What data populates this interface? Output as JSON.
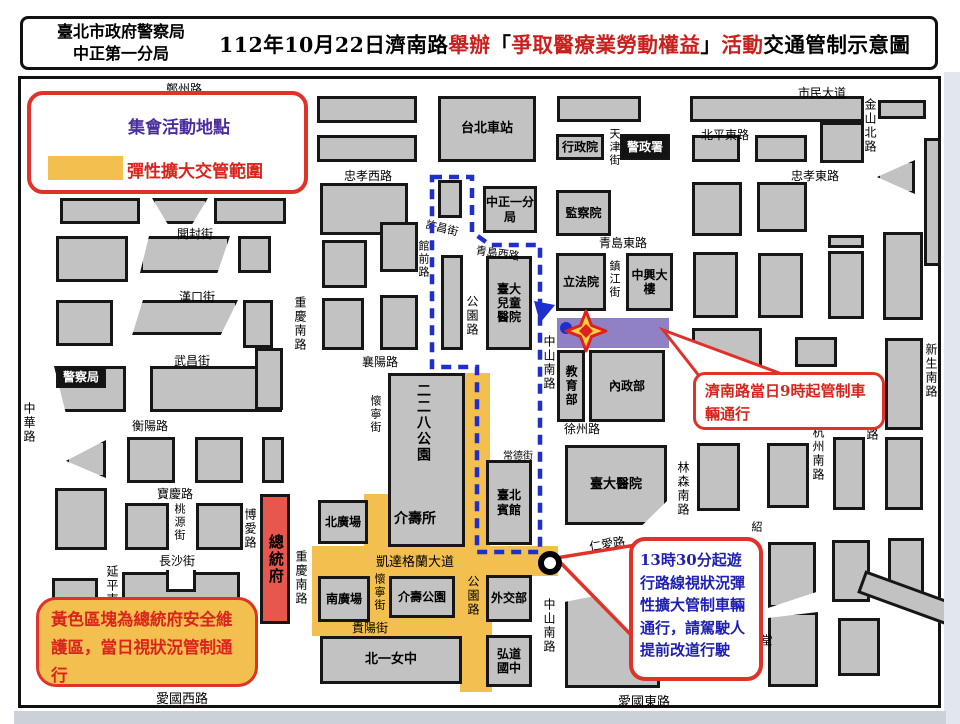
{
  "header": {
    "unit_line1": "臺北市政府警察局",
    "unit_line2": "中正第一分局",
    "title_segments": [
      {
        "text": "112年10月22日濟南路",
        "color": "black"
      },
      {
        "text": "舉辦",
        "color": "red"
      },
      {
        "text": "「",
        "color": "black"
      },
      {
        "text": "爭取醫療業勞動權益",
        "color": "red"
      },
      {
        "text": "」",
        "color": "black"
      },
      {
        "text": "活動",
        "color": "red"
      },
      {
        "text": "交通管制示意圖",
        "color": "black"
      }
    ]
  },
  "legend": {
    "star_label": "集會活動地點",
    "zone_label": "彈性擴大交管範圍"
  },
  "callouts": {
    "jinan": "濟南路當日9時起管制車輛通行",
    "flex": "13時30分起遊行路線視狀況彈性擴大管制車輛通行，請駕駛人提前改道行駛",
    "president": "黃色區塊為總統府安全維護區，當日視狀況管制通行"
  },
  "colors": {
    "accent_red": "#e03228",
    "text_red": "#d9251d",
    "text_blue": "#1f1fb4",
    "legend_purple": "#4b2e9e",
    "zone_yellow": "#f3bf4e",
    "jinan_purple": "#8f81c4",
    "president_red": "#e8574d",
    "route_blue": "#1e2ecf",
    "block_gray": "#c2c2c2"
  },
  "map": {
    "jinan_road_label": "濟南路",
    "yellow_zones": [
      [
        462,
        373,
        28,
        178
      ],
      [
        312,
        546,
        246,
        30
      ],
      [
        312,
        574,
        180,
        62
      ],
      [
        460,
        574,
        32,
        118
      ],
      [
        364,
        494,
        26,
        54
      ]
    ],
    "blocks": [
      {
        "x": 60,
        "y": 198,
        "w": 80,
        "h": 26
      },
      {
        "x": 152,
        "y": 198,
        "w": 56,
        "h": 26,
        "c": "polygon(0 0,100% 0,72% 100%,28% 100%)"
      },
      {
        "x": 214,
        "y": 198,
        "w": 72,
        "h": 26
      },
      {
        "x": 56,
        "y": 236,
        "w": 72,
        "h": 46
      },
      {
        "x": 140,
        "y": 236,
        "w": 90,
        "h": 37,
        "c": "polygon(10% 0,100% 0,86% 100%,0 100%)"
      },
      {
        "x": 238,
        "y": 236,
        "w": 33,
        "h": 37
      },
      {
        "x": 56,
        "y": 300,
        "w": 57,
        "h": 46
      },
      {
        "x": 130,
        "y": 300,
        "w": 108,
        "h": 35,
        "c": "polygon(12% 0,100% 0,84% 100%,2% 100%)"
      },
      {
        "x": 243,
        "y": 300,
        "w": 30,
        "h": 48
      },
      {
        "x": 54,
        "y": 366,
        "w": 72,
        "h": 46,
        "c": "polygon(0 0,100% 0,100% 100%,16% 100%)"
      },
      {
        "x": 150,
        "y": 366,
        "w": 132,
        "h": 46
      },
      {
        "x": 255,
        "y": 348,
        "w": 28,
        "h": 62
      },
      {
        "x": 66,
        "y": 440,
        "w": 40,
        "h": 38,
        "c": "polygon(100% 0,100% 100%,0 55%)"
      },
      {
        "x": 127,
        "y": 437,
        "w": 48,
        "h": 46
      },
      {
        "x": 195,
        "y": 437,
        "w": 48,
        "h": 46
      },
      {
        "x": 262,
        "y": 437,
        "w": 22,
        "h": 46
      },
      {
        "x": 55,
        "y": 488,
        "w": 52,
        "h": 62
      },
      {
        "x": 125,
        "y": 503,
        "w": 44,
        "h": 47
      },
      {
        "x": 196,
        "y": 503,
        "w": 47,
        "h": 47
      },
      {
        "x": 52,
        "y": 578,
        "w": 46,
        "h": 45
      },
      {
        "x": 122,
        "y": 572,
        "w": 118,
        "h": 50
      },
      {
        "x": 166,
        "y": 570,
        "w": 30,
        "h": 22,
        "k": "wh"
      },
      {
        "x": 317,
        "y": 96,
        "w": 100,
        "h": 27
      },
      {
        "x": 317,
        "y": 135,
        "w": 100,
        "h": 27
      },
      {
        "x": 320,
        "y": 183,
        "w": 88,
        "h": 52
      },
      {
        "x": 322,
        "y": 240,
        "w": 45,
        "h": 48
      },
      {
        "x": 380,
        "y": 222,
        "w": 38,
        "h": 50
      },
      {
        "x": 322,
        "y": 298,
        "w": 42,
        "h": 52
      },
      {
        "x": 380,
        "y": 295,
        "w": 38,
        "h": 55
      },
      {
        "x": 438,
        "y": 180,
        "w": 24,
        "h": 38
      },
      {
        "x": 441,
        "y": 255,
        "w": 22,
        "h": 95
      },
      {
        "x": 388,
        "y": 373,
        "w": 77,
        "h": 174
      },
      {
        "x": 557,
        "y": 96,
        "w": 84,
        "h": 26
      },
      {
        "x": 690,
        "y": 96,
        "w": 174,
        "h": 26
      },
      {
        "x": 878,
        "y": 100,
        "w": 48,
        "h": 19
      },
      {
        "x": 924,
        "y": 138,
        "w": 17,
        "h": 128
      },
      {
        "x": 692,
        "y": 135,
        "w": 48,
        "h": 27
      },
      {
        "x": 755,
        "y": 135,
        "w": 52,
        "h": 27
      },
      {
        "x": 820,
        "y": 122,
        "w": 44,
        "h": 41
      },
      {
        "x": 877,
        "y": 160,
        "w": 38,
        "h": 34,
        "c": "polygon(100% 0,100% 100%,0 50%)"
      },
      {
        "x": 692,
        "y": 182,
        "w": 50,
        "h": 54
      },
      {
        "x": 757,
        "y": 182,
        "w": 50,
        "h": 50
      },
      {
        "x": 828,
        "y": 235,
        "w": 36,
        "h": 13
      },
      {
        "x": 828,
        "y": 251,
        "w": 36,
        "h": 68
      },
      {
        "x": 883,
        "y": 232,
        "w": 40,
        "h": 88
      },
      {
        "x": 693,
        "y": 252,
        "w": 45,
        "h": 66
      },
      {
        "x": 758,
        "y": 253,
        "w": 45,
        "h": 65
      },
      {
        "x": 692,
        "y": 328,
        "w": 70,
        "h": 40
      },
      {
        "x": 795,
        "y": 337,
        "w": 42,
        "h": 30
      },
      {
        "x": 885,
        "y": 338,
        "w": 38,
        "h": 92
      },
      {
        "x": 697,
        "y": 443,
        "w": 43,
        "h": 68
      },
      {
        "x": 767,
        "y": 443,
        "w": 42,
        "h": 65
      },
      {
        "x": 833,
        "y": 437,
        "w": 32,
        "h": 73
      },
      {
        "x": 885,
        "y": 437,
        "w": 38,
        "h": 73
      },
      {
        "x": 768,
        "y": 542,
        "w": 48,
        "h": 66,
        "c": "polygon(0 0,100% 0,100% 76%,0 100%)"
      },
      {
        "x": 832,
        "y": 540,
        "w": 38,
        "h": 62
      },
      {
        "x": 888,
        "y": 538,
        "w": 36,
        "h": 62
      },
      {
        "x": 858,
        "y": 588,
        "w": 108,
        "h": 24,
        "r": 20
      },
      {
        "x": 565,
        "y": 583,
        "w": 95,
        "h": 105,
        "c": "polygon(0 18%,100% 0,100% 100%,0 100%)"
      },
      {
        "x": 768,
        "y": 612,
        "w": 50,
        "h": 75,
        "c": "polygon(0 8%,100% 0,100% 100%,0 100%)"
      },
      {
        "x": 838,
        "y": 618,
        "w": 42,
        "h": 58
      }
    ],
    "buildings": [
      {
        "t": "台北車站",
        "x": 438,
        "y": 96,
        "w": 98,
        "h": 66,
        "fs": 13
      },
      {
        "t": "行政院",
        "x": 556,
        "y": 134,
        "w": 48,
        "h": 26,
        "fs": 12
      },
      {
        "t": "警政署",
        "x": 620,
        "y": 134,
        "w": 50,
        "h": 26,
        "fs": 12,
        "k": "dark"
      },
      {
        "t": "中正一分局",
        "x": 483,
        "y": 186,
        "w": 54,
        "h": 47,
        "fs": 12
      },
      {
        "t": "監察院",
        "x": 556,
        "y": 190,
        "w": 55,
        "h": 46,
        "fs": 12
      },
      {
        "t": "立法院",
        "x": 556,
        "y": 253,
        "w": 50,
        "h": 58,
        "fs": 12
      },
      {
        "t": "中興大樓",
        "x": 626,
        "y": 253,
        "w": 47,
        "h": 58,
        "fs": 12
      },
      {
        "t": "臺大兒童醫院",
        "x": 486,
        "y": 256,
        "w": 46,
        "h": 94,
        "fs": 12,
        "pad": "0 8px"
      },
      {
        "t": "教育部",
        "x": 557,
        "y": 350,
        "w": 28,
        "h": 72,
        "fs": 12,
        "k": "vt"
      },
      {
        "t": "內政部",
        "x": 589,
        "y": 350,
        "w": 76,
        "h": 72,
        "fs": 12
      },
      {
        "t": "臺大醫院",
        "x": 565,
        "y": 445,
        "w": 102,
        "h": 80,
        "fs": 13,
        "c": "polygon(0 0,100% 0,100% 70%,76% 100%,0 100%)"
      },
      {
        "t": "臺北賓館",
        "x": 486,
        "y": 460,
        "w": 46,
        "h": 85,
        "fs": 12,
        "pad": "0 8px"
      },
      {
        "t": "外交部",
        "x": 486,
        "y": 575,
        "w": 46,
        "h": 47,
        "fs": 12
      },
      {
        "t": "弘道國中",
        "x": 486,
        "y": 635,
        "w": 46,
        "h": 52,
        "fs": 12,
        "pad": "0 8px"
      },
      {
        "t": "北一女中",
        "x": 320,
        "y": 636,
        "w": 142,
        "h": 48,
        "fs": 13
      },
      {
        "t": "介壽公園",
        "x": 389,
        "y": 576,
        "w": 66,
        "h": 42,
        "fs": 12
      },
      {
        "t": "南廣場",
        "x": 318,
        "y": 576,
        "w": 52,
        "h": 46,
        "fs": 12
      },
      {
        "t": "北廣場",
        "x": 318,
        "y": 500,
        "w": 50,
        "h": 44,
        "fs": 12
      },
      {
        "t": "總統府",
        "x": 260,
        "y": 494,
        "w": 30,
        "h": 130,
        "fs": 15,
        "k": "red vt"
      },
      {
        "t": "警察局",
        "x": 56,
        "y": 366,
        "w": 50,
        "h": 22,
        "fs": 12,
        "k": "dark"
      }
    ],
    "street_labels": [
      {
        "t": "鄭州路",
        "x": 166,
        "y": 80,
        "fs": 12
      },
      {
        "t": "市民大道",
        "x": 798,
        "y": 84,
        "fs": 12
      },
      {
        "t": "北平東路",
        "x": 701,
        "y": 126,
        "fs": 12
      },
      {
        "t": "忠孝西路",
        "x": 344,
        "y": 167,
        "fs": 12
      },
      {
        "t": "忠孝東路",
        "x": 791,
        "y": 167,
        "fs": 12
      },
      {
        "t": "開封街",
        "x": 177,
        "y": 225,
        "fs": 12
      },
      {
        "t": "許昌街",
        "x": 428,
        "y": 216,
        "fs": 11,
        "rot": 14
      },
      {
        "t": "青島西路",
        "x": 477,
        "y": 242,
        "fs": 11,
        "rot": 8
      },
      {
        "t": "青島東路",
        "x": 599,
        "y": 234,
        "fs": 12
      },
      {
        "t": "漢口街",
        "x": 179,
        "y": 288,
        "fs": 12
      },
      {
        "t": "武昌街",
        "x": 174,
        "y": 352,
        "fs": 12
      },
      {
        "t": "襄陽路",
        "x": 362,
        "y": 353,
        "fs": 12
      },
      {
        "t": "衡陽路",
        "x": 132,
        "y": 417,
        "fs": 12
      },
      {
        "t": "寶慶路",
        "x": 157,
        "y": 485,
        "fs": 12
      },
      {
        "t": "長沙街",
        "x": 159,
        "y": 552,
        "fs": 12
      },
      {
        "t": "常德街",
        "x": 503,
        "y": 447,
        "fs": 10
      },
      {
        "t": "徐州路",
        "x": 564,
        "y": 420,
        "fs": 12
      },
      {
        "t": "凱達格蘭大道",
        "x": 376,
        "y": 551,
        "fs": 13
      },
      {
        "t": "貴陽街",
        "x": 352,
        "y": 619,
        "fs": 12
      },
      {
        "t": "仁愛路",
        "x": 588,
        "y": 538,
        "fs": 12,
        "rot": -9
      },
      {
        "t": "愛國西路",
        "x": 156,
        "y": 688,
        "fs": 13
      },
      {
        "t": "愛國東路",
        "x": 618,
        "y": 691,
        "fs": 13
      },
      {
        "t": "濟南路",
        "x": 597,
        "y": 324,
        "fs": 13,
        "b": 1
      },
      {
        "t": "介壽所",
        "x": 394,
        "y": 508,
        "fs": 14,
        "b": 1
      },
      {
        "t": "二二八公園",
        "x": 413,
        "y": 383,
        "v": 1,
        "fs": 14,
        "b": 1
      },
      {
        "t": "金山北路",
        "x": 862,
        "y": 98,
        "v": 1,
        "fs": 12
      },
      {
        "t": "天津街",
        "x": 606,
        "y": 128,
        "v": 1,
        "fs": 11
      },
      {
        "t": "鎮江街",
        "x": 606,
        "y": 260,
        "v": 1,
        "fs": 11
      },
      {
        "t": "中華路",
        "x": 21,
        "y": 402,
        "v": 1,
        "fs": 12
      },
      {
        "t": "重慶南路",
        "x": 292,
        "y": 296,
        "v": 1,
        "fs": 12
      },
      {
        "t": "重慶南路",
        "x": 293,
        "y": 550,
        "v": 1,
        "fs": 12
      },
      {
        "t": "博愛路",
        "x": 242,
        "y": 508,
        "v": 1,
        "fs": 12
      },
      {
        "t": "桃源街",
        "x": 171,
        "y": 503,
        "v": 1,
        "fs": 11
      },
      {
        "t": "延平南",
        "x": 104,
        "y": 565,
        "v": 1,
        "fs": 12
      },
      {
        "t": "懷寧街",
        "x": 367,
        "y": 395,
        "v": 1,
        "fs": 11
      },
      {
        "t": "懷寧街",
        "x": 371,
        "y": 573,
        "v": 1,
        "fs": 11
      },
      {
        "t": "館前路",
        "x": 415,
        "y": 240,
        "v": 1,
        "fs": 11
      },
      {
        "t": "公園路",
        "x": 464,
        "y": 295,
        "v": 1,
        "fs": 12
      },
      {
        "t": "公園路",
        "x": 465,
        "y": 575,
        "v": 1,
        "fs": 12
      },
      {
        "t": "中山南路",
        "x": 541,
        "y": 335,
        "v": 1,
        "fs": 12
      },
      {
        "t": "中山南路",
        "x": 541,
        "y": 598,
        "v": 1,
        "fs": 12
      },
      {
        "t": "林森南路",
        "x": 675,
        "y": 461,
        "v": 1,
        "fs": 12
      },
      {
        "t": "杭州南路",
        "x": 810,
        "y": 426,
        "v": 1,
        "fs": 12
      },
      {
        "t": "新生南路",
        "x": 923,
        "y": 343,
        "v": 1,
        "fs": 12
      },
      {
        "t": "路",
        "x": 864,
        "y": 428,
        "v": 1,
        "fs": 12
      },
      {
        "t": "紹",
        "x": 748,
        "y": 521,
        "v": 1,
        "fs": 11
      },
      {
        "t": "堂",
        "x": 758,
        "y": 634,
        "v": 1,
        "fs": 12
      }
    ],
    "bottom_artifacts": [
      [
        30,
        120
      ],
      [
        165,
        60
      ],
      [
        240,
        70
      ],
      [
        325,
        130
      ],
      [
        470,
        70
      ],
      [
        555,
        110
      ],
      [
        680,
        80
      ],
      [
        775,
        100
      ],
      [
        880,
        55
      ]
    ]
  }
}
